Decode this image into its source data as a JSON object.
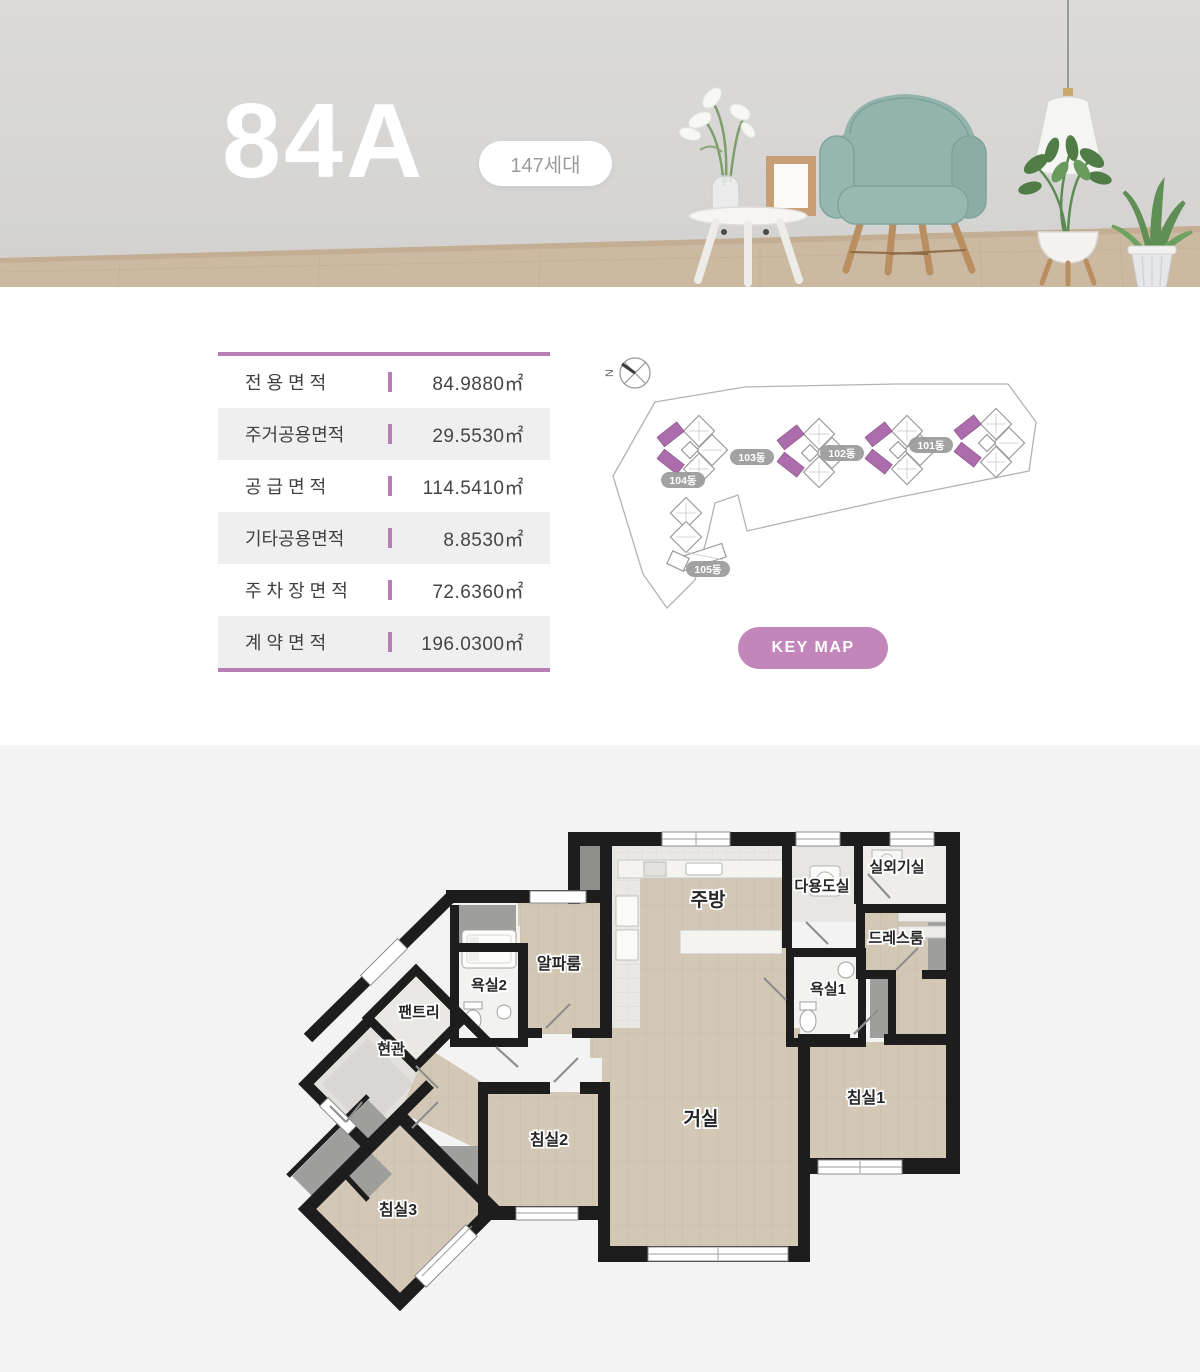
{
  "hero": {
    "unit_name": "84A",
    "badge": "147세대"
  },
  "area_table": {
    "accent_color": "#b87db4",
    "rows": [
      {
        "label": "전 용 면 적",
        "value": "84.9880㎡"
      },
      {
        "label": "주거공용면적",
        "value": "29.5530㎡"
      },
      {
        "label": "공 급 면 적",
        "value": "114.5410㎡"
      },
      {
        "label": "기타공용면적",
        "value": "8.8530㎡"
      },
      {
        "label": "주 차 장 면 적",
        "value": "72.6360㎡"
      },
      {
        "label": "계 약 면 적",
        "value": "196.0300㎡"
      }
    ]
  },
  "key_map": {
    "compass_label": "N",
    "button_label": "KEY MAP",
    "button_color": "#c286ba",
    "highlight_color": "#ad6cab",
    "buildings": [
      {
        "label": "101동"
      },
      {
        "label": "102동"
      },
      {
        "label": "103동"
      },
      {
        "label": "104동"
      },
      {
        "label": "105동"
      }
    ]
  },
  "floor_plan": {
    "rooms": [
      {
        "label": "실외기실"
      },
      {
        "label": "다용도실"
      },
      {
        "label": "주방"
      },
      {
        "label": "드레스룸"
      },
      {
        "label": "욕실1"
      },
      {
        "label": "알파룸"
      },
      {
        "label": "욕실2"
      },
      {
        "label": "팬트리"
      },
      {
        "label": "현관"
      },
      {
        "label": "침실2"
      },
      {
        "label": "거실"
      },
      {
        "label": "침실1"
      },
      {
        "label": "침실3"
      }
    ]
  }
}
